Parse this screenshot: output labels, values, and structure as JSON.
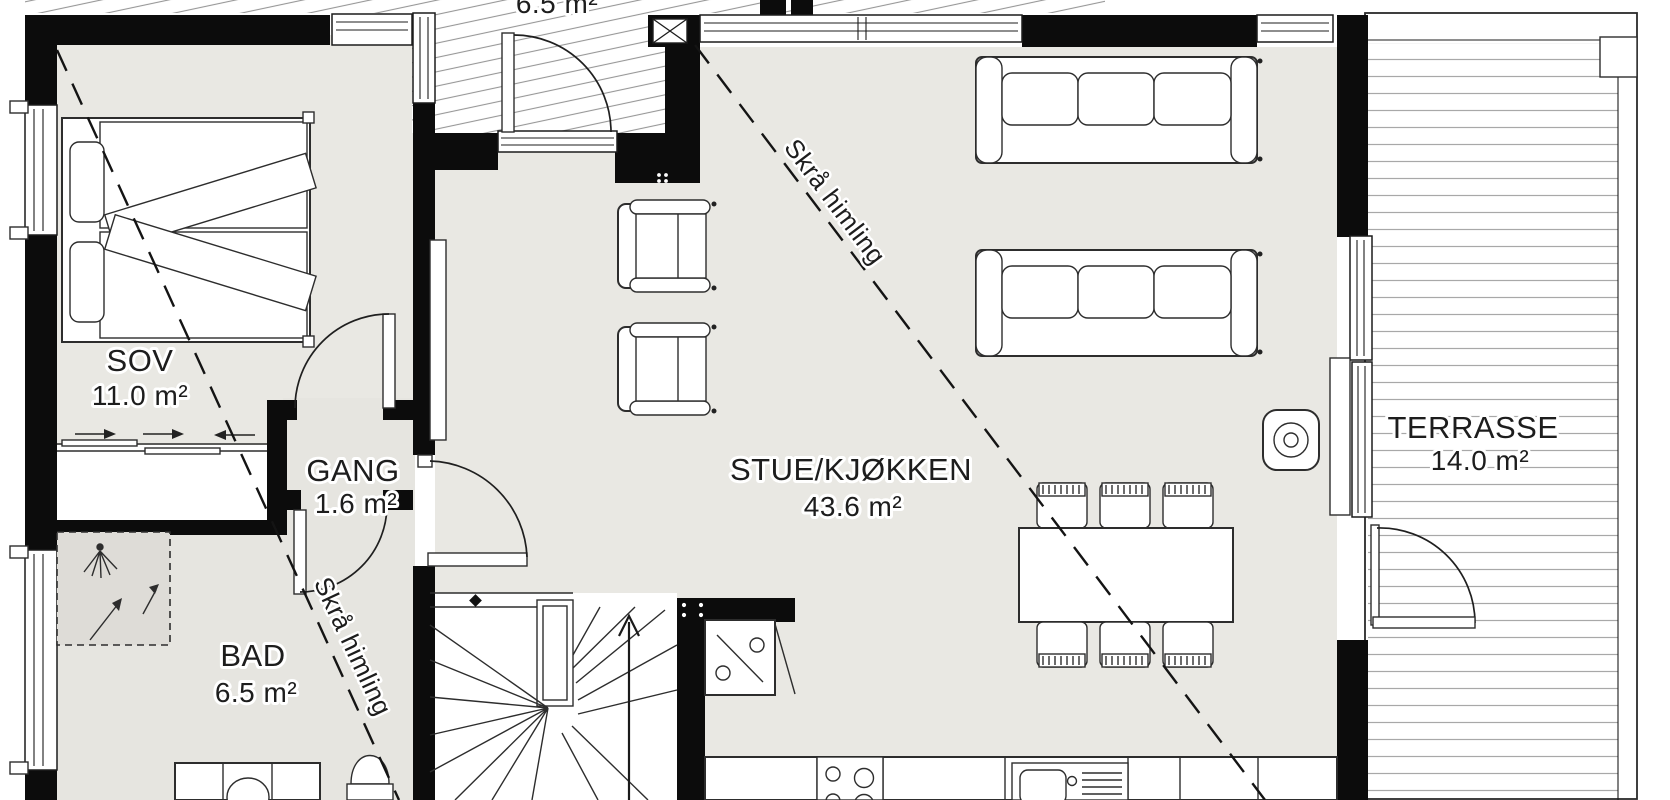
{
  "plan": {
    "rooms": [
      {
        "id": "sov",
        "name": "SOV",
        "area": "11.0 m²"
      },
      {
        "id": "gang",
        "name": "GANG",
        "area": "1.6 m²"
      },
      {
        "id": "bad",
        "name": "BAD",
        "area": "6.5 m²"
      },
      {
        "id": "stue-kjokken",
        "name": "STUE/KJØKKEN",
        "area": "43.6 m²"
      },
      {
        "id": "terrasse",
        "name": "TERRASSE",
        "area": "14.0 m²"
      }
    ],
    "top_partial_area_label": "6.5 m²",
    "annotations": [
      {
        "id": "sloped-ceiling-left",
        "text": "Skrå himling"
      },
      {
        "id": "sloped-ceiling-right",
        "text": "Skrå himling"
      }
    ],
    "colors": {
      "floor": "#e9e8e3",
      "bath_floor": "#e6e5e0",
      "wall": "#0c0c0c",
      "line": "#2d2d2d",
      "background": "#ffffff"
    }
  }
}
